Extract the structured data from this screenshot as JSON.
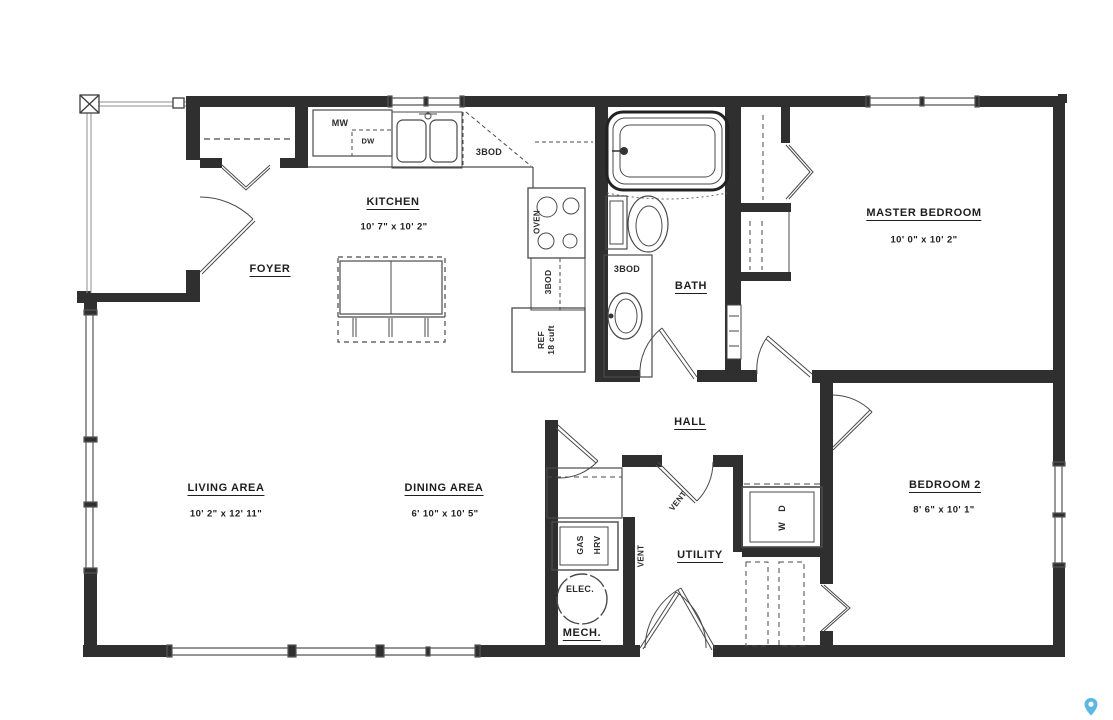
{
  "plan": {
    "background": "#ffffff",
    "wall_color": "#2f2f2f",
    "line_color": "#4a4a4a",
    "pin_color": "#5cb8e0"
  },
  "rooms": {
    "kitchen": {
      "label": "KITCHEN",
      "dims": "10' 7\" x 10' 2\""
    },
    "foyer": {
      "label": "FOYER"
    },
    "master_bedroom": {
      "label": "MASTER BEDROOM",
      "dims": "10' 0\" x 10' 2\""
    },
    "bath": {
      "label": "BATH"
    },
    "hall": {
      "label": "HALL"
    },
    "living_area": {
      "label": "LIVING AREA",
      "dims": "10' 2\" x 12' 11\""
    },
    "dining_area": {
      "label": "DINING AREA",
      "dims": "6' 10\" x 10' 5\""
    },
    "utility": {
      "label": "UTILITY"
    },
    "mech": {
      "label": "MECH."
    },
    "bedroom_2": {
      "label": "BEDROOM 2",
      "dims": "8' 6\" x 10' 1\""
    }
  },
  "fixtures": {
    "microwave": "MW",
    "dishwasher": "DW",
    "cabinet_3bod": "3BOD",
    "oven": "OVEN",
    "fridge": "REF",
    "fridge_size": "18 cuft",
    "gas": "GAS",
    "hrv": "HRV",
    "vent": "VENT",
    "electrical": "ELEC.",
    "washer_dryer": "W D"
  }
}
